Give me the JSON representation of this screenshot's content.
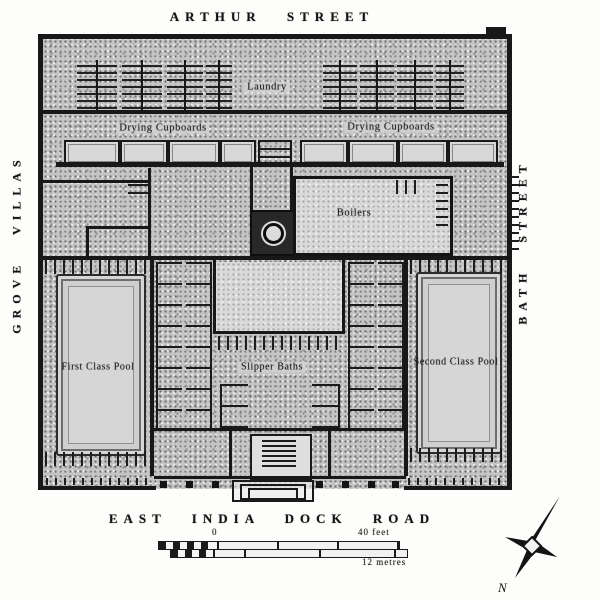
{
  "streets": {
    "top": "ARTHUR STREET",
    "left": "GROVE VILLAS",
    "right": "BATH STREET",
    "bottom": "EAST INDIA DOCK ROAD"
  },
  "rooms": {
    "laundry": "Laundry",
    "drying_cupboards_left": "Drying Cupboards",
    "drying_cupboards_right": "Drying Cupboards",
    "boilers": "Boilers",
    "first_class_pool": "First Class Pool",
    "slipper_baths": "Slipper Baths",
    "second_class_pool": "Second Class Pool"
  },
  "scale_bar": {
    "zero_label": "0",
    "imperial_label": "40 feet",
    "metric_label": "12 metres"
  },
  "compass": {
    "north_label": "N"
  },
  "colors": {
    "paper": "#fdfdfb",
    "wall": "#181818",
    "stipple_fill": "#c5c5c5",
    "room_fill": "#d9d9d9"
  }
}
